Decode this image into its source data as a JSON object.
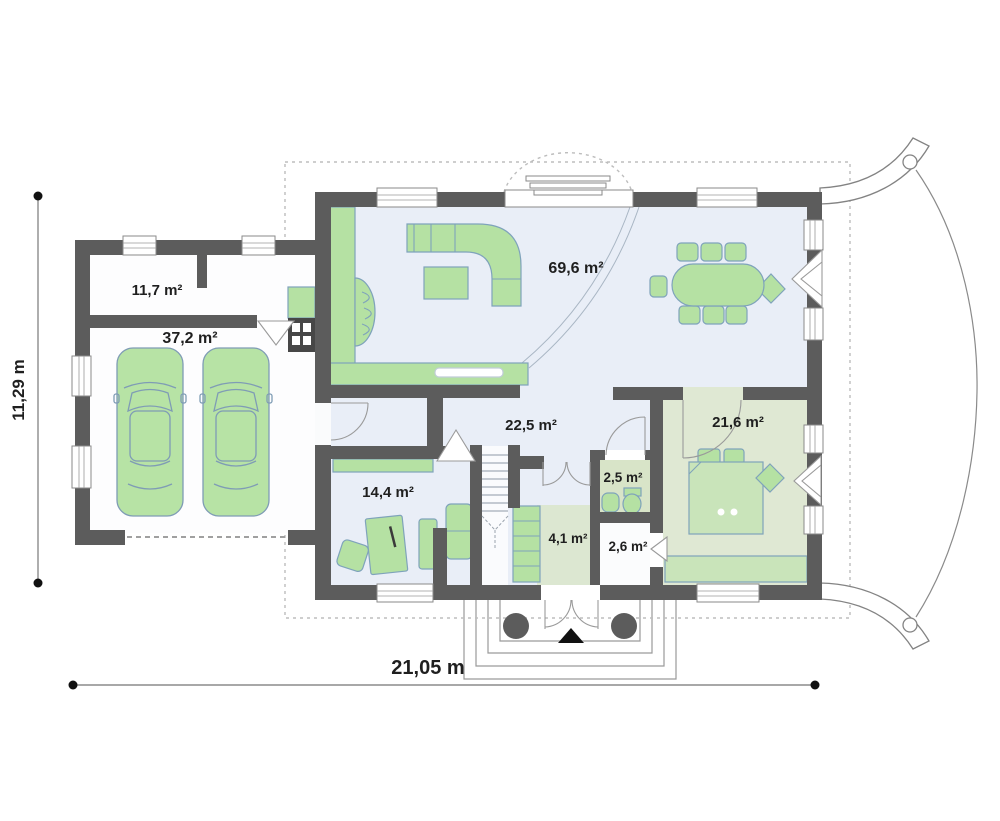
{
  "plan": {
    "type": "floor-plan",
    "dimension_labels": {
      "width": "21,05 m",
      "height": "11,29 m"
    },
    "rooms": [
      {
        "key": "utility",
        "area_label": "11,7 m²"
      },
      {
        "key": "garage",
        "area_label": "37,2 m²"
      },
      {
        "key": "living",
        "area_label": "69,6 m²"
      },
      {
        "key": "hall",
        "area_label": "22,5 m²"
      },
      {
        "key": "bedroom",
        "area_label": "21,6 m²"
      },
      {
        "key": "study",
        "area_label": "14,4 m²"
      },
      {
        "key": "wc",
        "area_label": "2,5 m²"
      },
      {
        "key": "vestibule",
        "area_label": "4,1 m²"
      },
      {
        "key": "storage",
        "area_label": "2,6 m²"
      }
    ],
    "icons": {
      "entrance_marker": "triangle-up-icon",
      "porch_columns": "column-circle-icon"
    },
    "colors": {
      "wall": "#5c5c5c",
      "chimney": "#474747",
      "floor_main": "#e9eef7",
      "floor_garage": "#fdfdfe",
      "floor_bedroom": "#dfe8d3",
      "floor_wc": "#d8e4c8",
      "floor_storage": "#fbfcfd",
      "floor_vestibule": "#dce7d1",
      "furniture_green": "#b5e1a3",
      "furniture_light": "#c9e4ba",
      "car_green": "#b7e3a5",
      "outline_blue": "#7fa3bb"
    }
  }
}
